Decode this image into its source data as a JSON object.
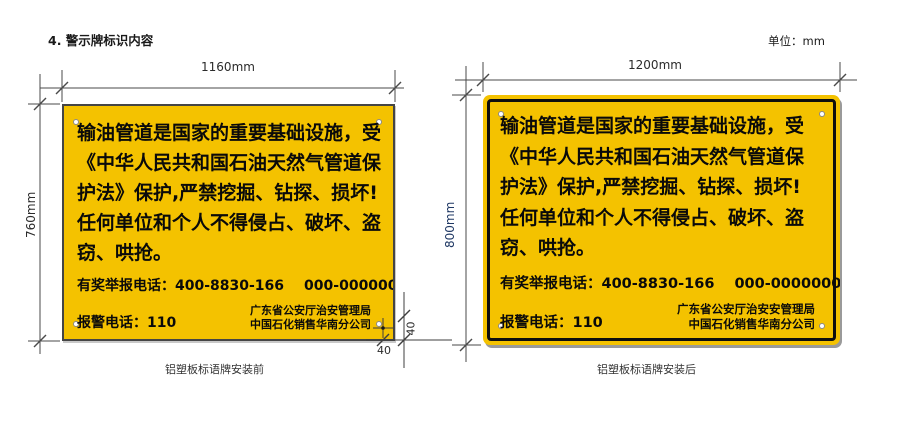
{
  "page": {
    "title": "4. 警示牌标识内容",
    "unit": "单位：mm"
  },
  "colors": {
    "sign_yellow": "#F4C200",
    "frame_black": "#0E0E0E",
    "dim_line_gray": "#4A4A4A",
    "height_label_navy": "#1F3864"
  },
  "sign_before": {
    "width_label": "1160mm",
    "height_label": "760mm",
    "caption": "铝塑板标语牌安装前",
    "lines": [
      "输油管道是国家的重要基础设施，受",
      "《中华人民共和国石油天然气管道保",
      "护法》保护,严禁挖掘、钻探、损坏!",
      "任何单位和个人不得侵占、破坏、盗",
      "窃、哄抢。"
    ],
    "hotline": "有奖举报电话：400-8830-166",
    "hotline_alt": "000-000000",
    "police": "报警电话：110",
    "org_line1": "广东省公安厅治安管理局",
    "org_line2": "中国石化销售华南分公司",
    "hole_offset_x": "40",
    "hole_offset_y": "40"
  },
  "sign_after": {
    "width_label": "1200mm",
    "height_label": "800mm",
    "caption": "铝塑板标语牌安装后",
    "lines": [
      "输油管道是国家的重要基础设施，受",
      "《中华人民共和国石油天然气管道保",
      "护法》保护,严禁挖掘、钻探、损坏!",
      "任何单位和个人不得侵占、破坏、盗",
      "窃、哄抢。"
    ],
    "hotline": "有奖举报电话：400-8830-166",
    "hotline_alt": "000-0000000",
    "police": "报警电话：110",
    "org_line1": "广东省公安厅治安安管理局",
    "org_line2": "中国石化销售华南分公司"
  }
}
